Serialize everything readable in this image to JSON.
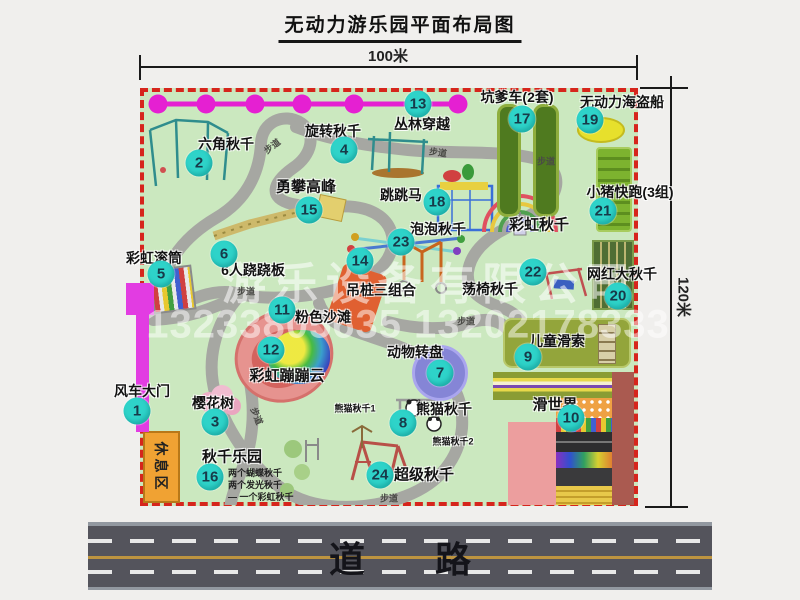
{
  "title": "无动力游乐园平面布局图",
  "dims": {
    "top": "100米",
    "right": "120米"
  },
  "road": {
    "label": "道路"
  },
  "watermark": {
    "line1": "游乐设备有限公司",
    "line2": "13233805635 13202178333"
  },
  "rest_area_label": "休息区",
  "path_label": "步道",
  "colors": {
    "park_green": "#cbe8bf",
    "border_red": "#d6251c",
    "badge_teal": "#2ed3c9",
    "jungle_magenta": "#e520d2",
    "road_gray": "#54545c",
    "road_yellow": "#bd9440"
  },
  "swing_park_notes": [
    "两个蝴蝶秋千",
    "两个发光秋千",
    "一个彩虹秋千"
  ],
  "attractions": [
    {
      "num": "1",
      "name": "风车大门",
      "badge": {
        "x": 137,
        "y": 411
      },
      "label": {
        "x": 142,
        "y": 391
      }
    },
    {
      "num": "2",
      "name": "六角秋千",
      "badge": {
        "x": 199,
        "y": 163
      },
      "label": {
        "x": 226,
        "y": 144
      }
    },
    {
      "num": "3",
      "name": "樱花树",
      "badge": {
        "x": 215,
        "y": 422
      },
      "label": {
        "x": 213,
        "y": 403
      }
    },
    {
      "num": "4",
      "name": "旋转秋千",
      "badge": {
        "x": 344,
        "y": 150
      },
      "label": {
        "x": 333,
        "y": 131
      }
    },
    {
      "num": "5",
      "name": "彩虹滚筒",
      "badge": {
        "x": 161,
        "y": 274
      },
      "label": {
        "x": 154,
        "y": 258
      }
    },
    {
      "num": "6",
      "name": "6人跷跷板",
      "badge": {
        "x": 224,
        "y": 254
      },
      "label": {
        "x": 253,
        "y": 270
      }
    },
    {
      "num": "7",
      "name": "动物转盘",
      "badge": {
        "x": 440,
        "y": 373
      },
      "label": {
        "x": 415,
        "y": 352
      }
    },
    {
      "num": "8",
      "name": "熊猫秋千",
      "badge": {
        "x": 403,
        "y": 423
      },
      "label": {
        "x": 444,
        "y": 409
      }
    },
    {
      "num": "9",
      "name": "儿童滑索",
      "badge": {
        "x": 528,
        "y": 357
      },
      "label": {
        "x": 557,
        "y": 341
      }
    },
    {
      "num": "10",
      "name": "滑世界",
      "badge": {
        "x": 571,
        "y": 418
      },
      "label": {
        "x": 555,
        "y": 404
      },
      "fs": 15
    },
    {
      "num": "11",
      "name": "粉色沙滩",
      "badge": {
        "x": 282,
        "y": 310
      },
      "label": {
        "x": 323,
        "y": 317
      }
    },
    {
      "num": "12",
      "name": "彩虹蹦蹦云",
      "badge": {
        "x": 271,
        "y": 350
      },
      "label": {
        "x": 287,
        "y": 375
      },
      "fs": 15
    },
    {
      "num": "13",
      "name": "丛林穿越",
      "badge": {
        "x": 418,
        "y": 104
      },
      "label": {
        "x": 422,
        "y": 124
      }
    },
    {
      "num": "14",
      "name": "吊桩三组合",
      "badge": {
        "x": 360,
        "y": 261
      },
      "label": {
        "x": 381,
        "y": 290
      }
    },
    {
      "num": "15",
      "name": "勇攀高峰",
      "badge": {
        "x": 309,
        "y": 210
      },
      "label": {
        "x": 306,
        "y": 186
      },
      "fs": 15
    },
    {
      "num": "16",
      "name": "秋千乐园",
      "badge": {
        "x": 210,
        "y": 477
      },
      "label": {
        "x": 232,
        "y": 456
      },
      "fs": 15
    },
    {
      "num": "17",
      "name": "坑爹车(2套)",
      "badge": {
        "x": 522,
        "y": 119
      },
      "label": {
        "x": 517,
        "y": 97
      }
    },
    {
      "num": "18",
      "name": "跳跳马",
      "badge": {
        "x": 437,
        "y": 202
      },
      "label": {
        "x": 401,
        "y": 195
      }
    },
    {
      "num": "19",
      "name": "无动力海盗船",
      "badge": {
        "x": 590,
        "y": 120
      },
      "label": {
        "x": 622,
        "y": 102
      }
    },
    {
      "num": "20",
      "name": "网红大秋千",
      "badge": {
        "x": 618,
        "y": 296
      },
      "label": {
        "x": 622,
        "y": 274
      }
    },
    {
      "num": "21",
      "name": "小猪快跑(3组)",
      "badge": {
        "x": 603,
        "y": 211
      },
      "label": {
        "x": 630,
        "y": 192
      }
    },
    {
      "num": "22",
      "name": "荡椅秋千",
      "badge": {
        "x": 533,
        "y": 272
      },
      "label": {
        "x": 490,
        "y": 289
      }
    },
    {
      "num": "23",
      "name": "泡泡秋千",
      "badge": {
        "x": 401,
        "y": 242
      },
      "label": {
        "x": 438,
        "y": 229
      }
    },
    {
      "num": "24",
      "name": "超级秋千",
      "badge": {
        "x": 380,
        "y": 475
      },
      "label": {
        "x": 424,
        "y": 474
      },
      "fs": 15
    },
    {
      "num": null,
      "name": "彩虹秋千",
      "label": {
        "x": 539,
        "y": 224
      },
      "fs": 15
    },
    {
      "num": null,
      "name": "熊猫秋千1",
      "label": {
        "x": 355,
        "y": 408
      },
      "fs": 9
    },
    {
      "num": null,
      "name": "熊猫秋千2",
      "label": {
        "x": 453,
        "y": 441
      },
      "fs": 9
    }
  ],
  "walkway_labels": [
    {
      "x": 272,
      "y": 146,
      "r": -38
    },
    {
      "x": 438,
      "y": 152,
      "r": 8
    },
    {
      "x": 546,
      "y": 161,
      "r": 0
    },
    {
      "x": 246,
      "y": 291,
      "r": 0
    },
    {
      "x": 257,
      "y": 416,
      "r": 68
    },
    {
      "x": 466,
      "y": 321,
      "r": 0
    },
    {
      "x": 389,
      "y": 498,
      "r": 0
    }
  ]
}
